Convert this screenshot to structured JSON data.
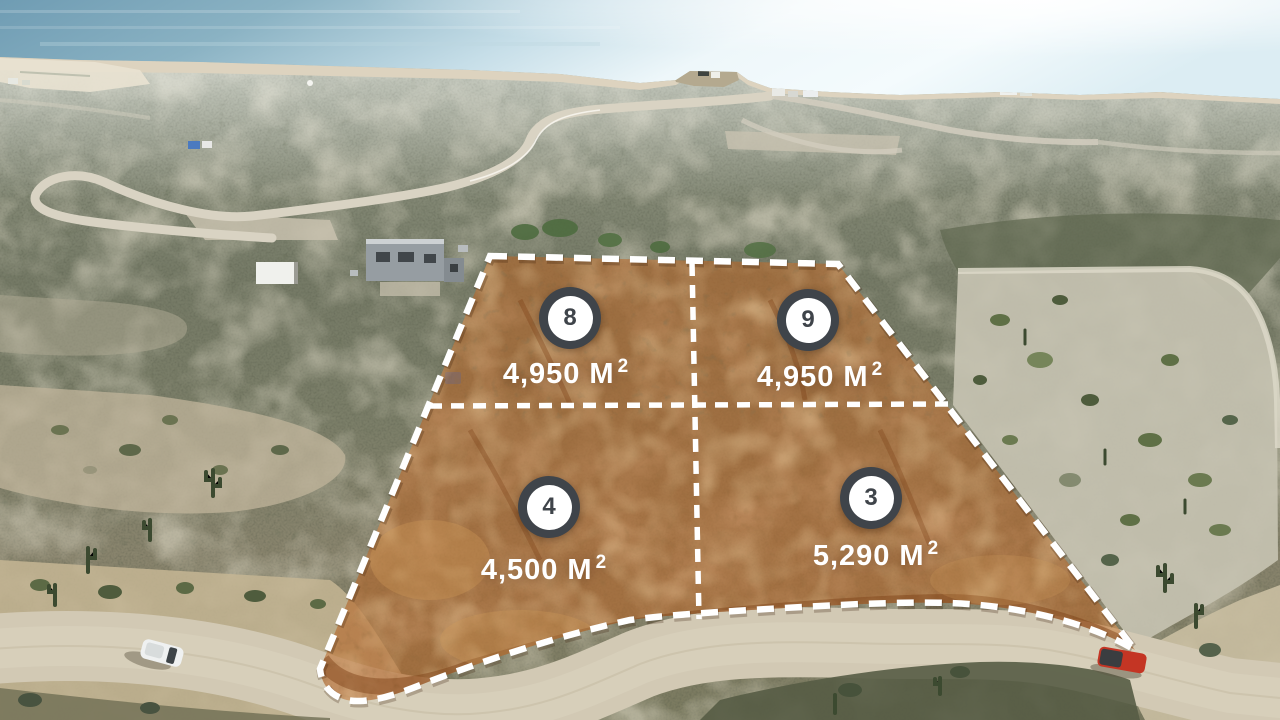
{
  "scene": {
    "description": "Aerial drone photo of desert real-estate lots outlined in white dashes above a dirt road, ocean on the horizon"
  },
  "lots": [
    {
      "number": "8",
      "area": "4,950",
      "unit": "M",
      "superscript": "2"
    },
    {
      "number": "9",
      "area": "4,950",
      "unit": "M",
      "superscript": "2"
    },
    {
      "number": "4",
      "area": "4,500",
      "unit": "M",
      "superscript": "2"
    },
    {
      "number": "3",
      "area": "5,290",
      "unit": "M",
      "superscript": "2"
    }
  ],
  "colors": {
    "lot_highlight": "#bd6f34",
    "boundary_dash": "#ffffff",
    "badge_ring": "#3f444a"
  }
}
